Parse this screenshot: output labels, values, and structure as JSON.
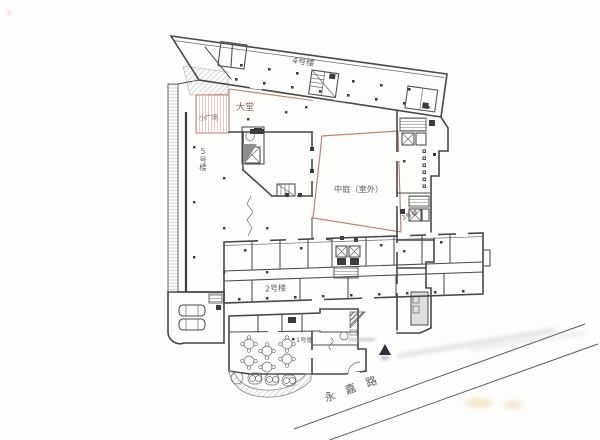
{
  "plan": {
    "labels": {
      "building1": "1号楼",
      "building2": "2号楼",
      "building3": "3号楼",
      "building4": "4号楼",
      "building5": "5号楼",
      "lobby": "大堂",
      "plaza": "小广场",
      "atrium": "中庭（室外）",
      "road": "永嘉路"
    },
    "colors": {
      "wall_line": "#474747",
      "red_boundary": "#c17b6f",
      "pink_hatch": "#dfc0bc",
      "gray_hatch": "#c6c6c6",
      "label_text": "#5f5f5f"
    }
  }
}
